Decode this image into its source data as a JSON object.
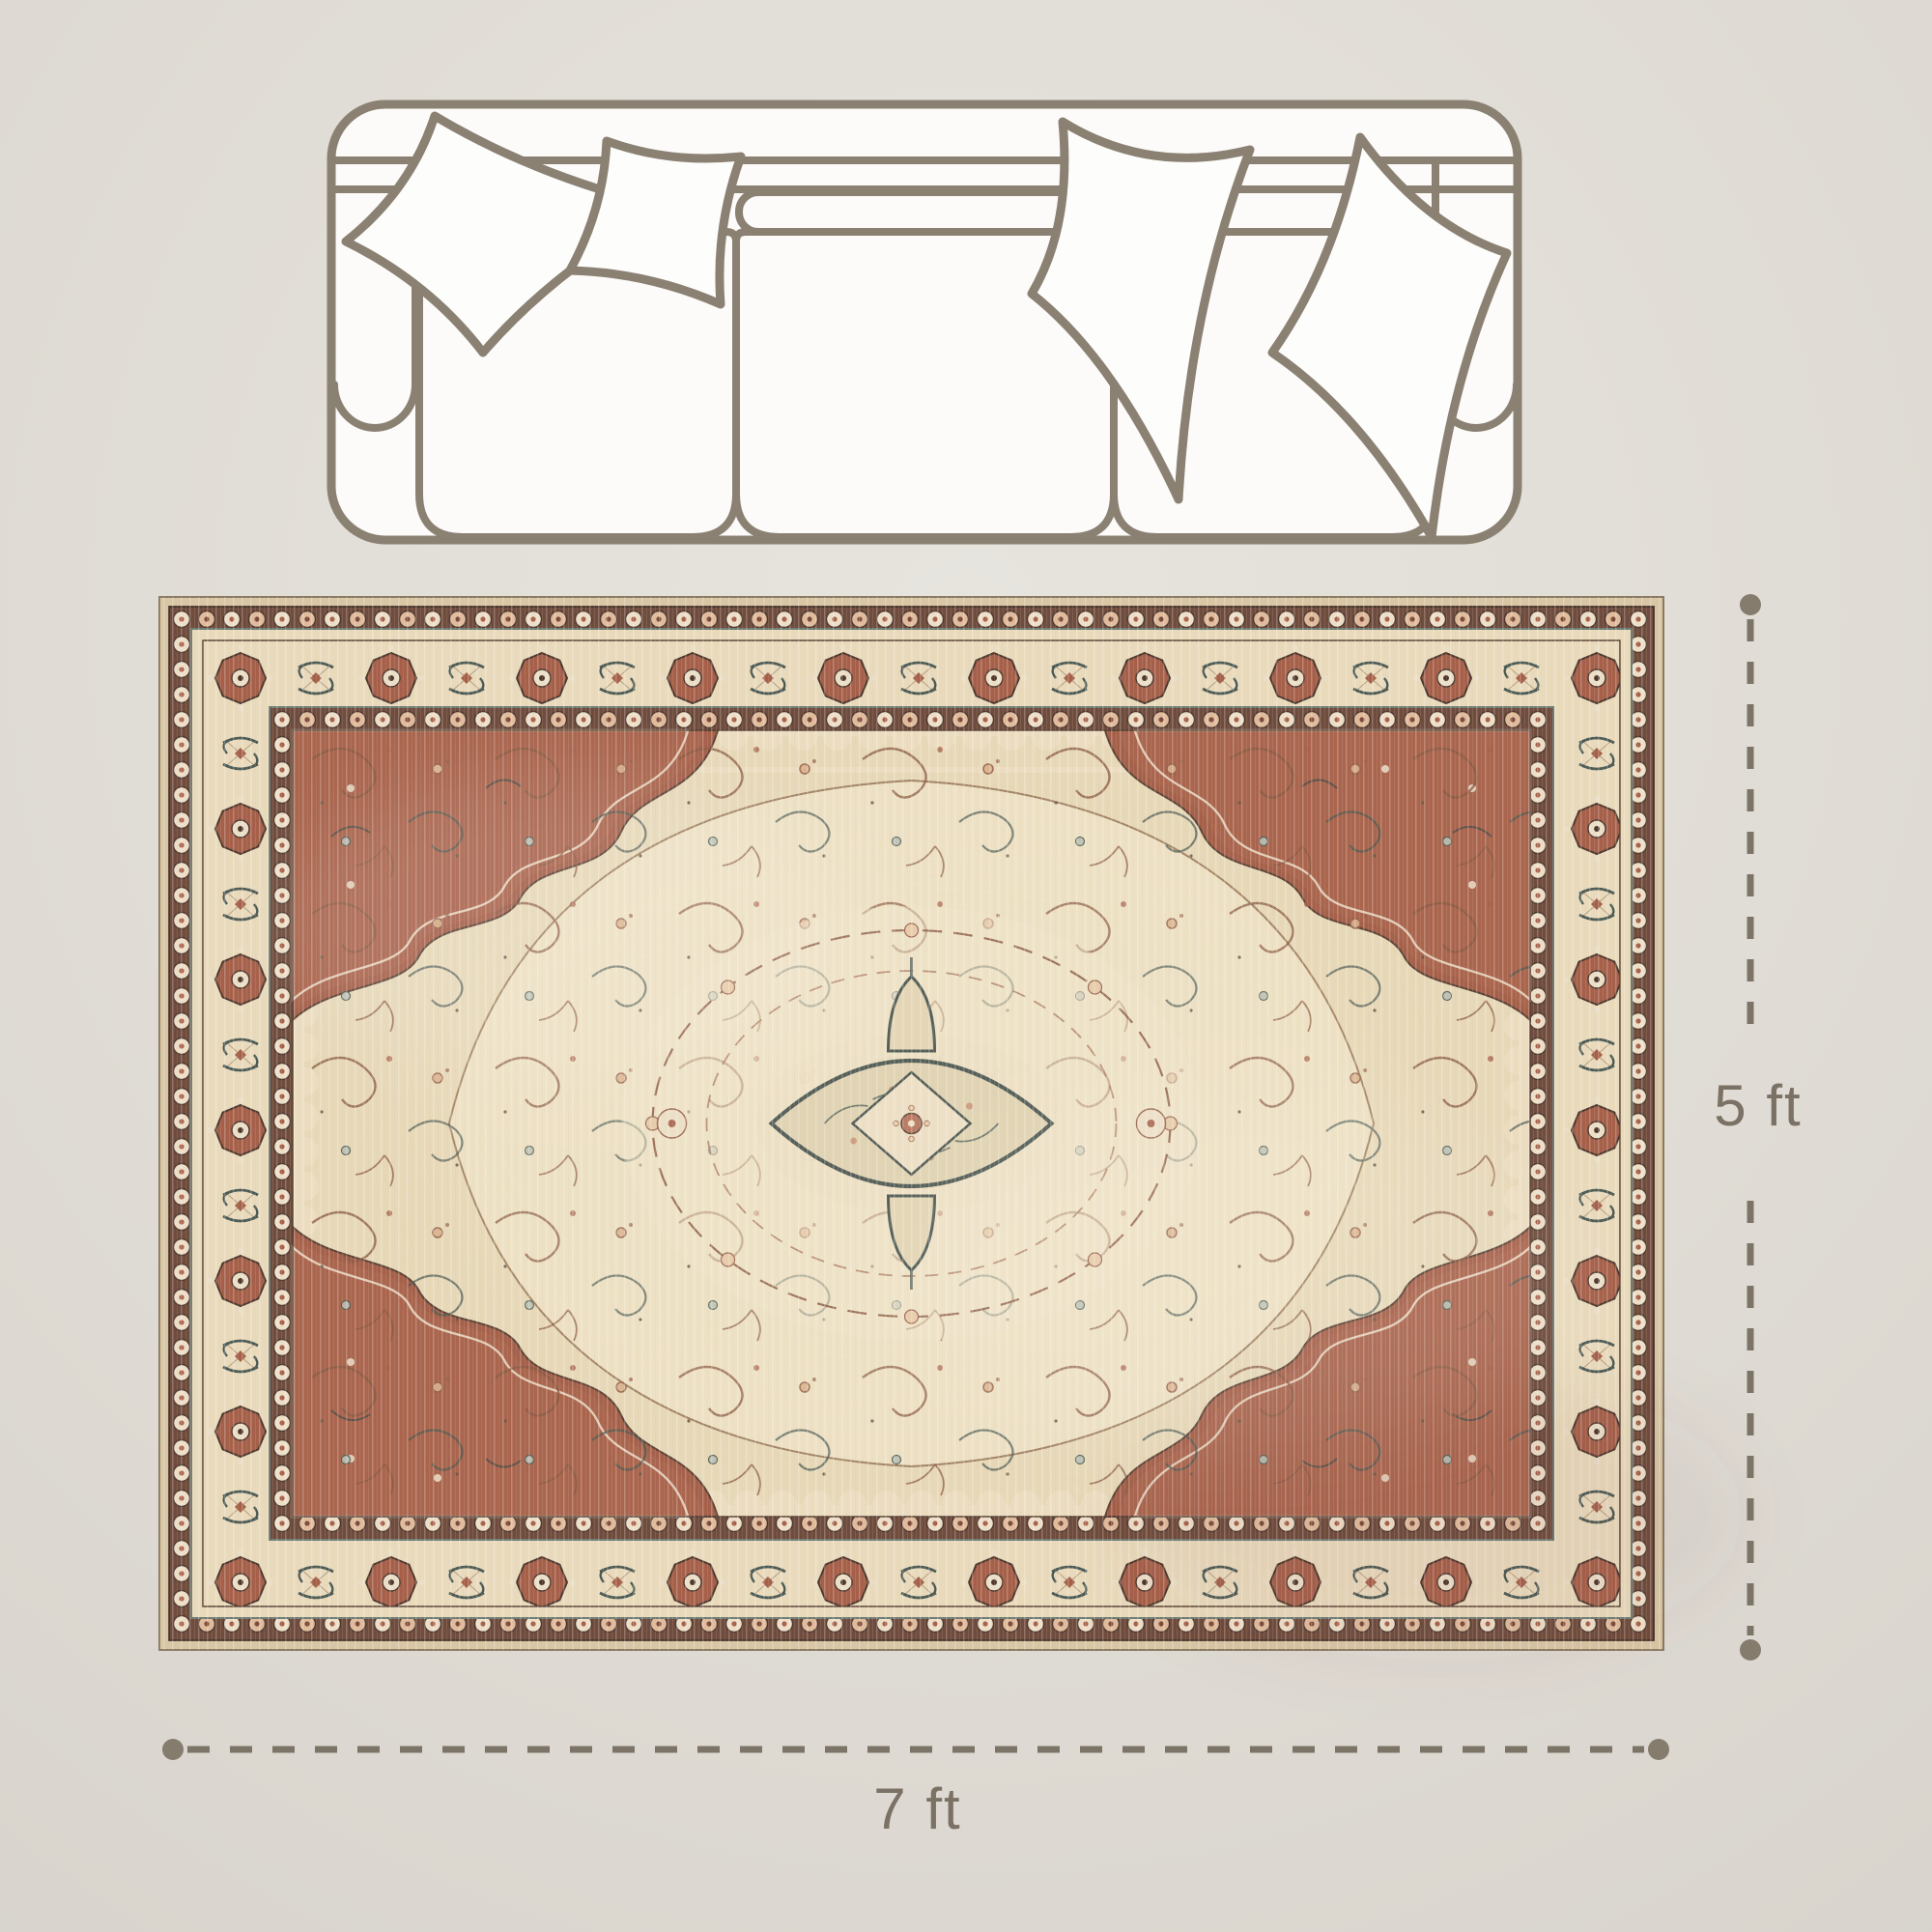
{
  "dimensions": {
    "width_label": "7 ft",
    "height_label": "5 ft"
  },
  "icons": {
    "sofa": "sofa-top-view-outline-icon",
    "pillows": "throw-pillow-outline-icons",
    "rug": "vintage-oriental-medallion-rug"
  },
  "colors": {
    "background": "#dedad3",
    "dimension_line": "#7c7467",
    "endpoint_dot": "#857c6e",
    "label_text": "#7b7265",
    "sofa_outline": "#8b8173",
    "sofa_fill": "#fcfbf9",
    "rug_edge_tan": "#d8c6a4",
    "rug_rosette_band": "#6f4c3d",
    "rug_border_cream": "#e9dabc",
    "rug_field": "#e7d8b8",
    "rug_rust": "#a5604a",
    "rug_dark_brown": "#4e382e",
    "rug_teal": "#4c5a54",
    "rug_cream": "#ecdfc8"
  }
}
